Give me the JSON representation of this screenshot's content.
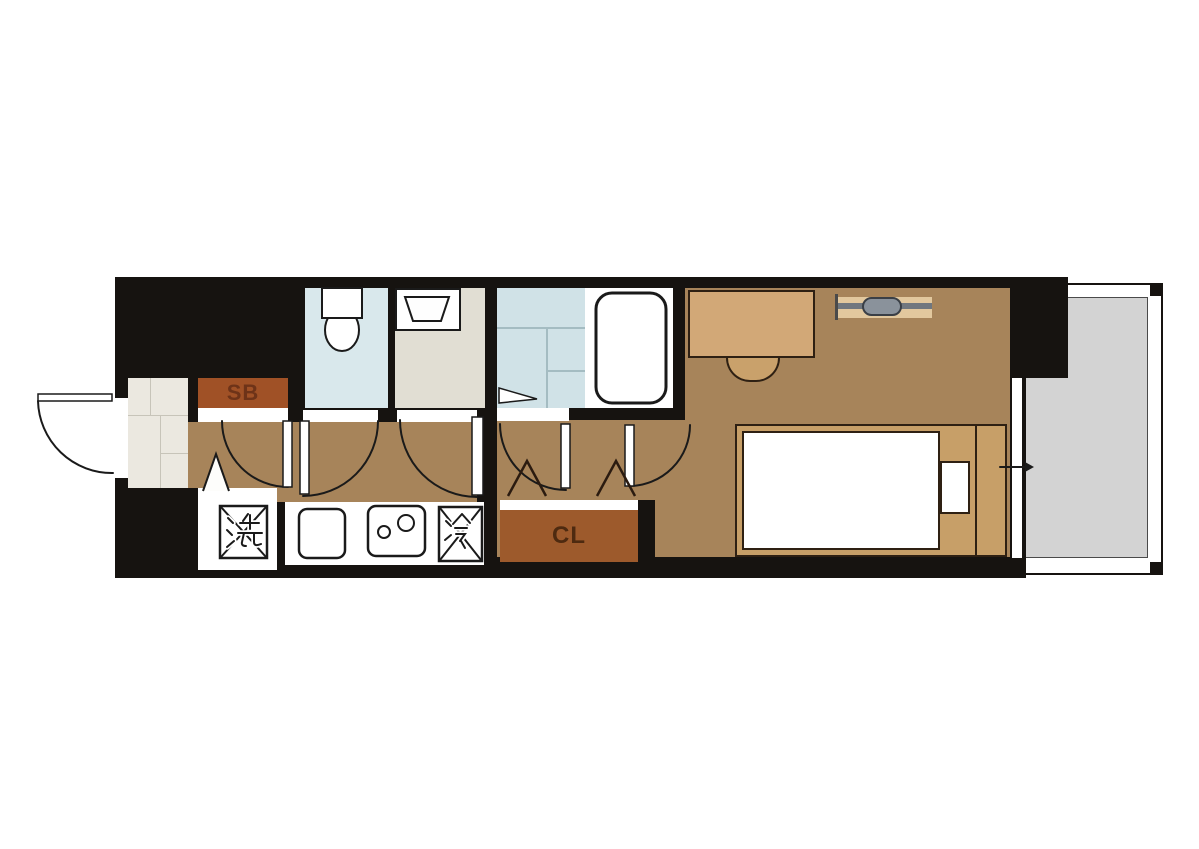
{
  "title": "studio-apartment-floor-plan",
  "labels": {
    "shoe_box": "SB",
    "closet": "CL",
    "washing_machine": "洗",
    "refrigerator": "冷"
  },
  "legend": {
    "sb": "shoe box",
    "cl": "closet",
    "washing_machine_symbol": "washing machine space",
    "refrigerator_symbol": "refrigerator space",
    "fixtures": [
      "entrance",
      "toilet",
      "washbasin",
      "shower room",
      "bathtub",
      "kitchen sink",
      "two-burner stove",
      "desk",
      "stool",
      "air conditioner",
      "bed",
      "pillow",
      "sliding window",
      "balcony"
    ]
  },
  "palette": {
    "wall": "#161310",
    "floor": "#A7845A",
    "entrance": "#EBE8E0",
    "tile_line": "#C7C4B9",
    "toilet_room": "#D9E8EC",
    "washroom": "#E1DED3",
    "shower": "#D0E2E7",
    "shower_line": "#A4BCC2",
    "sb_box": "#A05126",
    "sb_text": "#6E3318",
    "cl_box": "#9D5A2C",
    "cl_text": "#4E2A10",
    "desk": "#D2A877",
    "stool": "#C9A16B",
    "bed_frame": "#C79F68",
    "balcony": "#D3D3D3",
    "ac_body": "#8A929B",
    "ac_bar": "#70777F",
    "ac_shelf": "#E2C89E",
    "line": "#1A1A1A",
    "white": "#FFFFFF"
  }
}
